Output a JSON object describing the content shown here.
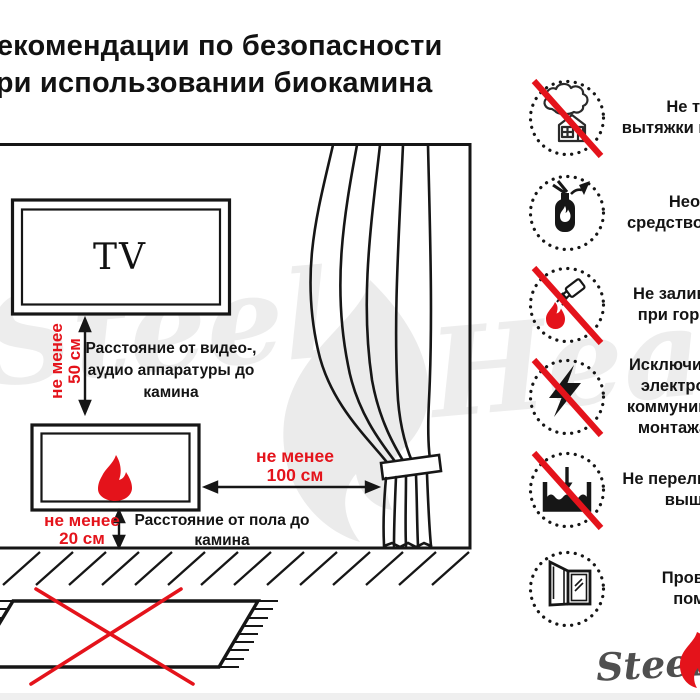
{
  "title": {
    "line1": "Рекомендации по безопасности",
    "line2": "при использовании биокамина"
  },
  "watermark": {
    "word1": "Steel",
    "word2": "Heat"
  },
  "logo": {
    "brand": "Steel"
  },
  "diagram": {
    "tv_label": "TV",
    "tv_distance": {
      "l1": "не менее",
      "l2": "50 см"
    },
    "tv_distance_desc": {
      "l1": "Расстояние от видео-,",
      "l2": "аудио аппаратуры до",
      "l3": "камина"
    },
    "curtain_distance": {
      "l1": "не менее",
      "l2": "100 см"
    },
    "floor_distance": {
      "l1": "не менее",
      "l2": "20 см"
    },
    "floor_distance_desc": {
      "l1": "Расстояние от пола до",
      "l2": "камина"
    }
  },
  "rules": [
    {
      "icon": "house-smoke-icon",
      "prohibition": true,
      "l1": "Не требуется",
      "l2": "вытяжки или дымохода"
    },
    {
      "icon": "fire-extinguisher-icon",
      "prohibition": false,
      "l1": "Необходимо",
      "l2": "средство для тушения"
    },
    {
      "icon": "refuel-while-burning-icon",
      "prohibition": true,
      "l1": "Не заливать топливо",
      "l2": "при горении камина"
    },
    {
      "icon": "lightning-icon",
      "prohibition": true,
      "l1": "Исключить прокладку",
      "l2": "электропроводки и",
      "l3": "коммуникаций в месте",
      "l4": "монтажа биокамина"
    },
    {
      "icon": "overfill-level-icon",
      "prohibition": true,
      "l1": "Не переливать топливо",
      "l2": "выше уровня"
    },
    {
      "icon": "open-window-icon",
      "prohibition": false,
      "l1": "Проветривать",
      "l2": "помещение"
    }
  ],
  "colors": {
    "accent_red": "#e4131b",
    "line": "#161616",
    "watermark_gray": "#ededed",
    "logo_gray": "#4f4f4f"
  }
}
